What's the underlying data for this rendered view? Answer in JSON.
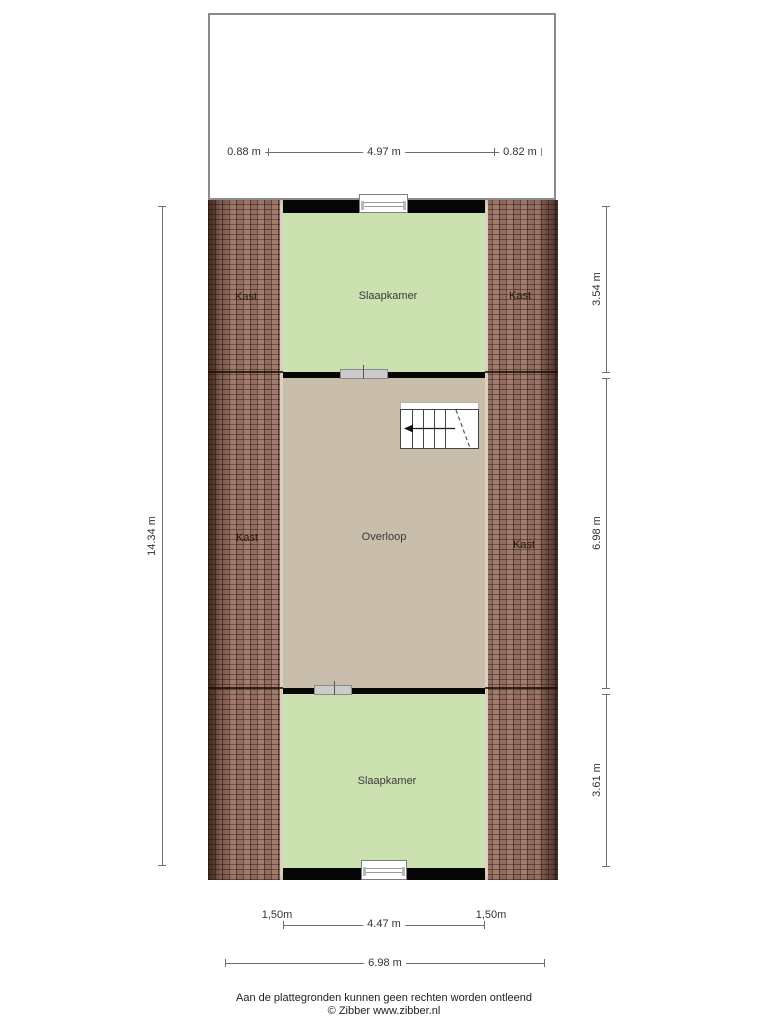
{
  "rooms": {
    "slaapkamer_top": "Slaapkamer",
    "slaapkamer_bottom": "Slaapkamer",
    "overloop": "Overloop",
    "kast_top_left": "Kast",
    "kast_top_right": "Kast",
    "kast_mid_left": "Kast",
    "kast_mid_right": "Kast"
  },
  "dimensions": {
    "roof_left": "0.88 m",
    "roof_center": "4.97 m",
    "roof_right": "0.82 m",
    "left_total": "14.34 m",
    "right_top": "3.54 m",
    "right_middle": "6.98 m",
    "right_bottom": "3.61 m",
    "bottom_inner_left": "1,50m",
    "bottom_inner_center": "4.47 m",
    "bottom_inner_right": "1,50m",
    "bottom_total": "6.98 m"
  },
  "footer": {
    "line1": "Aan de plattegronden kunnen geen rechten worden ontleend",
    "line2": "© Zibber www.zibber.nl"
  },
  "colors": {
    "room_green": "#cbe1b0",
    "landing_tan": "#c8bcaa",
    "roof_tile": "#9d7567",
    "wall_black": "#060606"
  }
}
